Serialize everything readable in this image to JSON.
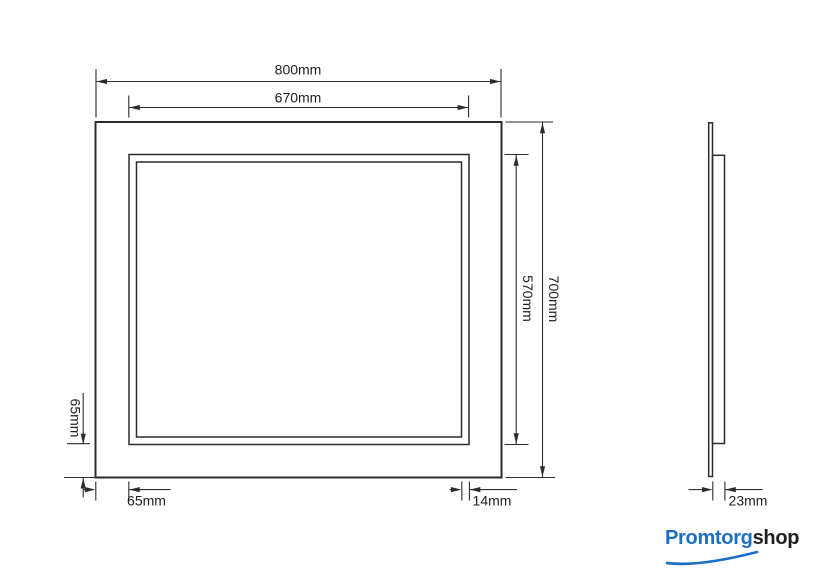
{
  "page": {
    "background": "#ffffff"
  },
  "drawing": {
    "line_color": "#2c2c2c",
    "text_color": "#1f1f1f",
    "front_view": {
      "outer_width_label": "800mm",
      "inner_width_label": "670mm",
      "outer_height_label": "700mm",
      "inner_height_label": "570mm",
      "left_margin_label": "65mm",
      "bottom_margin_label": "65mm",
      "frame_width_label": "14mm"
    },
    "side_view": {
      "depth_label": "23mm"
    }
  },
  "logo": {
    "text_primary": "Promtorg",
    "text_secondary": "shop",
    "primary_color": "#1c6fc4",
    "secondary_color": "#221f1f"
  }
}
